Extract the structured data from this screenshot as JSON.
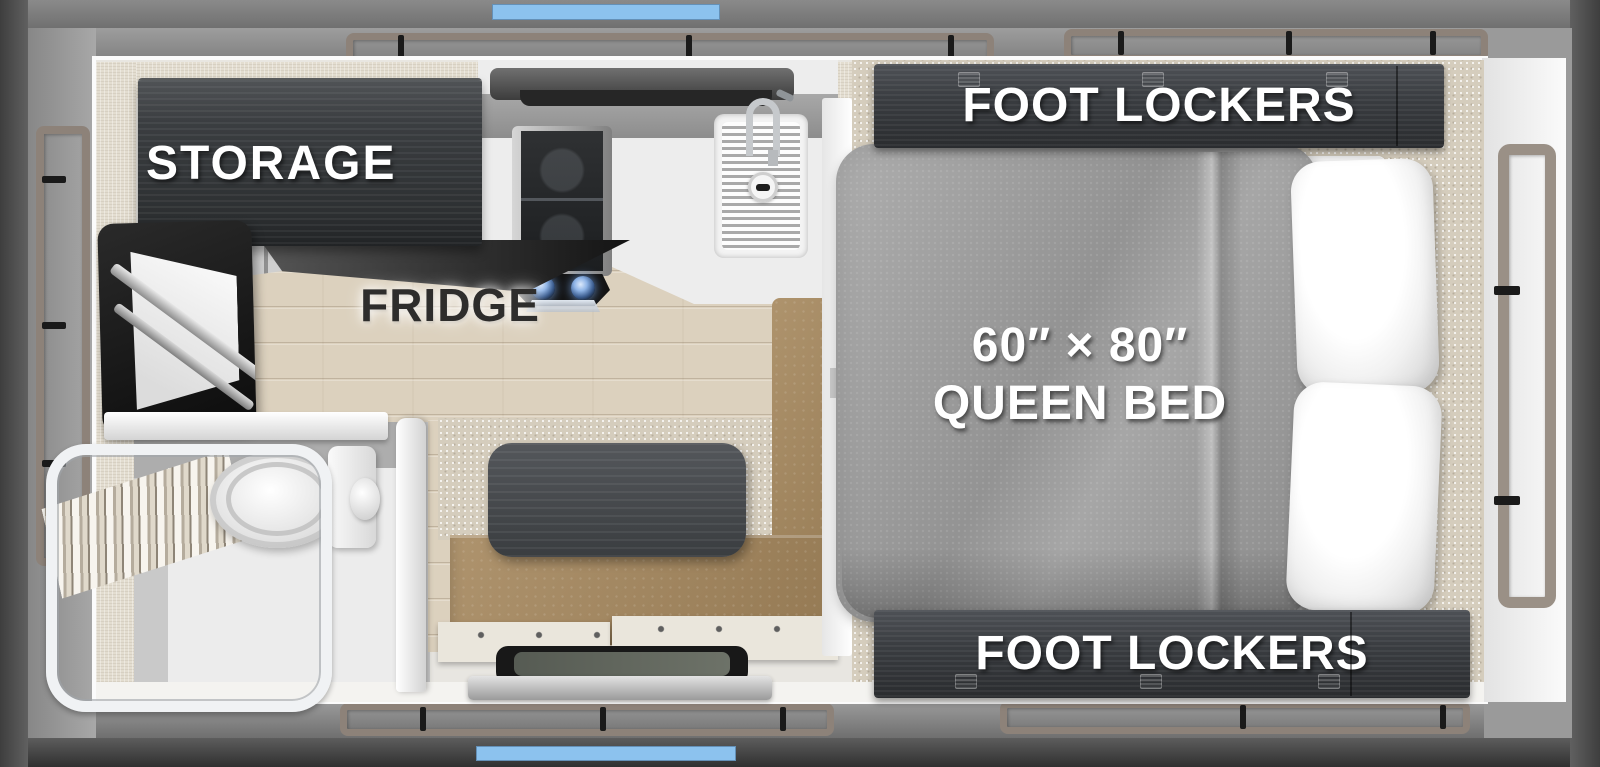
{
  "title": "truck camper floor plan",
  "labels": {
    "storage": "STORAGE",
    "fridge": "FRIDGE",
    "foot_lockers_top": "FOOT LOCKERS",
    "foot_lockers_bottom": "FOOT LOCKERS",
    "bed_size": "60″ × 80″",
    "bed_type": "QUEEN BED"
  },
  "colors": {
    "accent_blue": "#8cc2ee",
    "wall_dark": "#4a4a4a",
    "wall_gray": "#8f8f8f",
    "trim_taupe": "#8d8279",
    "cabinet_dark": "#34373a",
    "bench_brown": "#a5875c",
    "table_dark": "#45484b",
    "bed_gray": "#9c9c9c",
    "floor_wood": "#dcd1be",
    "carpet_beige": "#d5cdbd",
    "label_white": "#ffffff",
    "label_dark": "#2e2d2c"
  }
}
